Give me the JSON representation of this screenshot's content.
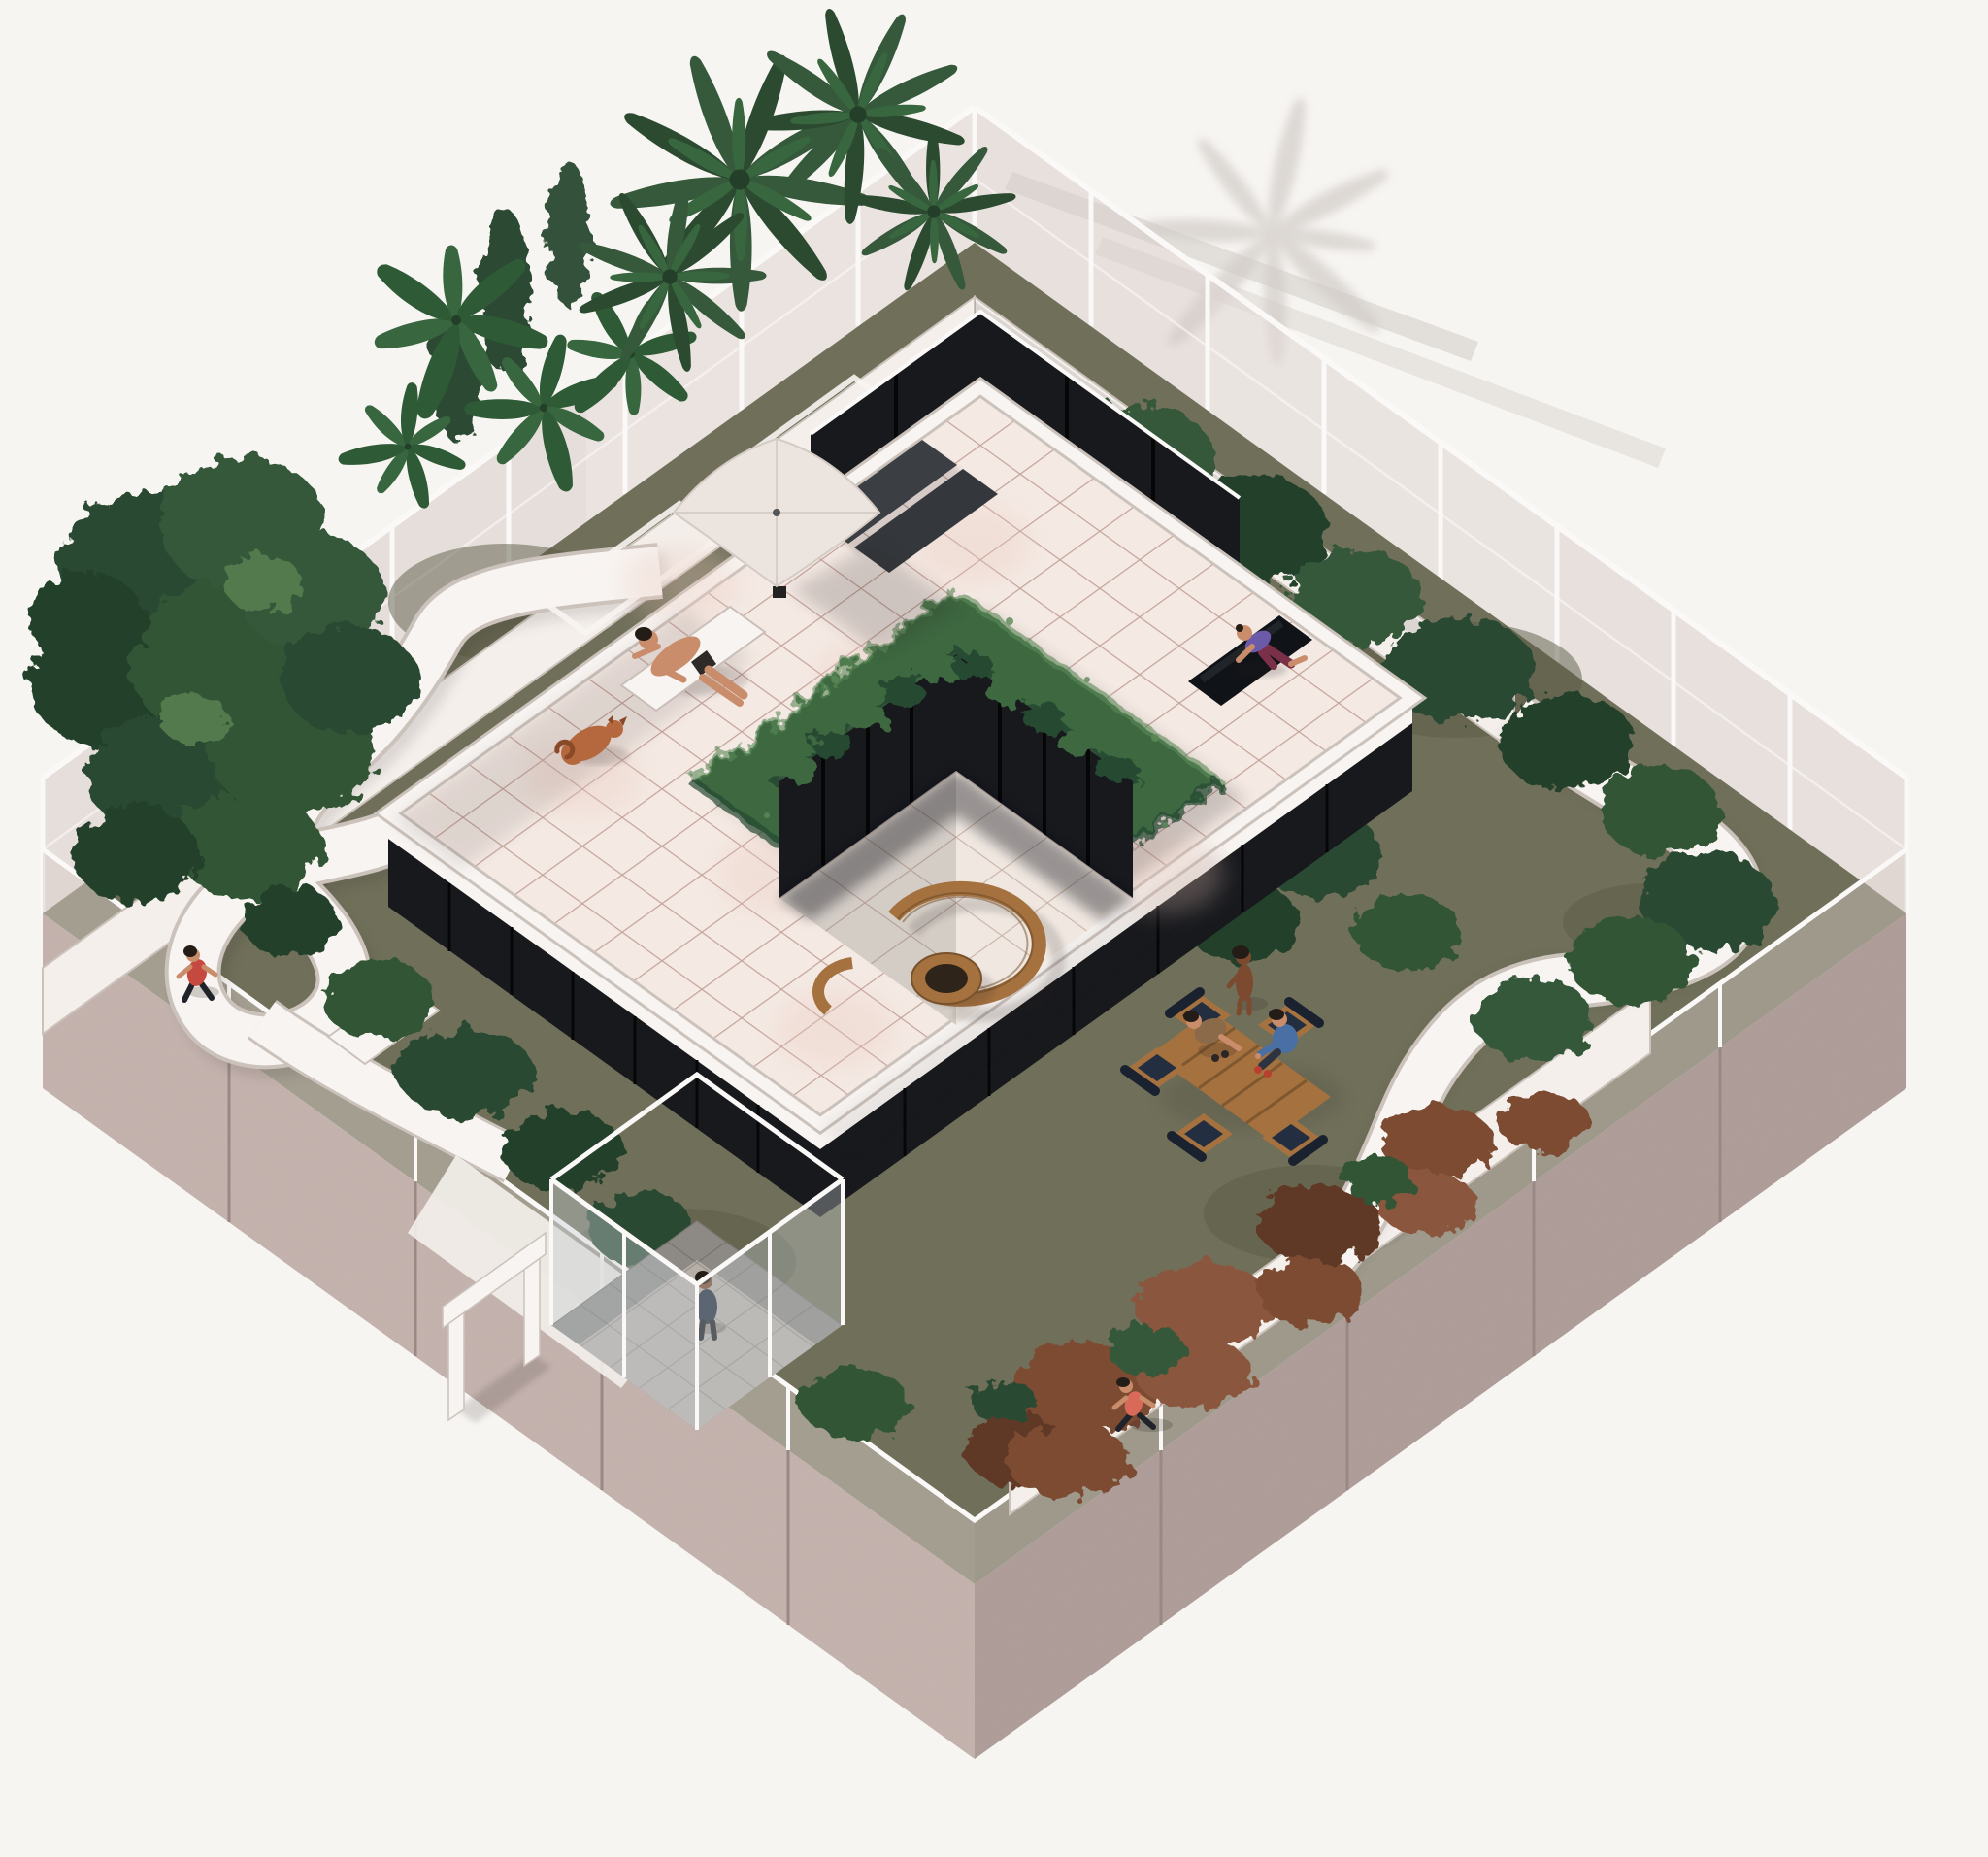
{
  "meta": {
    "label": "Axonometric architectural rendering of a square rooftop garden pavilion with a sunken central courtyard, winding white ramps, glass perimeter walls and people relaxing"
  },
  "palette": {
    "bg": "#f7f5f2",
    "bgShadow": "#d2ccc8",
    "shadow": "#2a2420",
    "soil": "#70705a",
    "soilDark": "#5a5a46",
    "stoneA": "#c7b5b0",
    "stoneB": "#b09e9a",
    "stoneJoint": "#998884",
    "glassFence": "#d8cbc7",
    "frame": "#fbf9f7",
    "glassDark": "#17191d",
    "mullion": "#060607",
    "glassLobby": "#c5cdd1",
    "concrete": "#b6afa8",
    "concreteLine": "#958e87",
    "tile": "#f4e9e3",
    "tileLine": "#c3a29a",
    "tileBlotch": "#e9c9bd",
    "tileC": "#efe7e0",
    "tileLineC": "#c9b2a8",
    "walkway": "#f4efeb",
    "pathEdge": "#ccc2bc",
    "white": "#f8f4f1",
    "parasol": "#ece4df",
    "slate": "#3b3f43",
    "wood": "#a4713f",
    "woodDark": "#77522c",
    "navy": "#232e40",
    "navyDark": "#1a2230",
    "hedge": "#3d6741",
    "hedgeDark": "#284830",
    "hedgeLight": "#5c8a58",
    "tree1": "#2b4a30",
    "tree2": "#35593a",
    "tree3": "#243f29",
    "tree4": "#315634",
    "treeHi": "#527a4e",
    "banana": "#2e5a36",
    "banana2": "#38663f",
    "rust1": "#7c4b33",
    "rust2": "#8a563c",
    "rustDark": "#5f3826",
    "skin": "#c98d6b",
    "skinDark": "#7c4a2e",
    "hair": "#241c16",
    "red": "#c6493f",
    "coral": "#d96a5a",
    "blue": "#4a6fa5",
    "purple": "#6a5aa8",
    "maroon": "#7a3048",
    "dogFur": "#b5683e",
    "dogDark": "#8a4a28",
    "shoe": "#b8402f",
    "denim": "#2d3440",
    "legDark": "#20242a"
  },
  "scene": {
    "setting": "rooftop-garden-axonometric",
    "people": [
      {
        "id": "sunbather",
        "label": "Person sunbathing on a lounger"
      },
      {
        "id": "dog",
        "label": "Dog resting beside the lounger"
      },
      {
        "id": "yoga",
        "label": "Person exercising on a black yoga mat"
      },
      {
        "id": "standing-woman",
        "label": "Person standing at the lounge area"
      },
      {
        "id": "crouching-man",
        "label": "Person leaning over the coffee table"
      },
      {
        "id": "seated-man",
        "label": "Person seated in an armchair"
      },
      {
        "id": "runner-west",
        "label": "Runner on the west loop ramp"
      },
      {
        "id": "runner-south",
        "label": "Runner on the south garden path"
      },
      {
        "id": "lobby-visitor",
        "label": "Person inside the glass lobby"
      }
    ],
    "features": [
      {
        "id": "courtyard-hedge",
        "label": "Vine-covered hedge ring around sunken courtyard"
      },
      {
        "id": "curved-bench",
        "label": "Curved wooden bench"
      },
      {
        "id": "fire-table",
        "label": "Round wooden fire table"
      },
      {
        "id": "parasol",
        "label": "White patio parasol"
      },
      {
        "id": "loungers",
        "label": "Pair of sun loungers"
      },
      {
        "id": "yoga-mat",
        "label": "Black yoga mat"
      },
      {
        "id": "lounge-set",
        "label": "Outdoor lounge chairs with wooden coffee table"
      },
      {
        "id": "lobby",
        "label": "Glass entrance lobby"
      },
      {
        "id": "portal",
        "label": "White entrance portal"
      },
      {
        "id": "ramp-west",
        "label": "Winding west ramp through trees"
      },
      {
        "id": "ramp-east",
        "label": "Sweeping east ramp"
      },
      {
        "id": "palms",
        "label": "Palm trees"
      },
      {
        "id": "terrace",
        "label": "Tiled roof terrace"
      },
      {
        "id": "perimeter",
        "label": "Glass balustrade on stone perimeter walls"
      }
    ]
  }
}
